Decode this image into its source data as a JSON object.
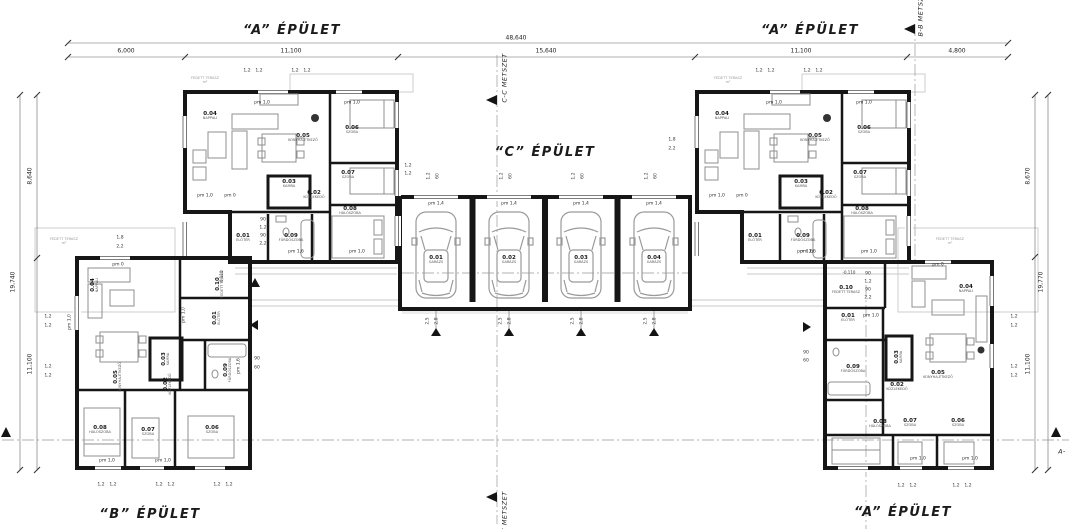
{
  "drawing": {
    "titles": {
      "building_a_top_left": "“A” ÉPÜLET",
      "building_a_top_right": "“A” ÉPÜLET",
      "building_c": "“C” ÉPÜLET",
      "building_b": "“B” ÉPÜLET",
      "building_a_bottom_right": "“A” ÉPÜLET"
    },
    "sections": {
      "bb": "B-B METSZET",
      "cc_top": "C-C METSZET",
      "cc_bottom": "C-C METSZET",
      "aa_right": "A-"
    },
    "dims": {
      "top_total": "48,640",
      "top_segments": [
        "6,000",
        "11,100",
        "15,640",
        "11,100",
        "4,800"
      ],
      "left_segments": [
        "8,640",
        "11,100"
      ],
      "left_total": "19,740",
      "right_segments": [
        "8,670",
        "11,100"
      ],
      "right_total": "19,770"
    }
  },
  "labels": {
    "rooms": [
      {
        "no": "0.04",
        "name": "NAPPALI",
        "x": 210,
        "y": 116
      },
      {
        "no": "0.05",
        "name": "KONYHA-ÉTKEZŐ",
        "x": 303,
        "y": 138
      },
      {
        "no": "0.06",
        "name": "SZOBA",
        "x": 352,
        "y": 130
      },
      {
        "no": "0.07",
        "name": "SZOBA",
        "x": 348,
        "y": 175
      },
      {
        "no": "0.03",
        "name": "KAMRA",
        "x": 289,
        "y": 184
      },
      {
        "no": "0.02",
        "name": "KÖZLEKEDŐ",
        "x": 314,
        "y": 195
      },
      {
        "no": "0.08",
        "name": "HÁLÓSZOBA",
        "x": 350,
        "y": 211
      },
      {
        "no": "0.01",
        "name": "ELŐTÉR",
        "x": 243,
        "y": 238
      },
      {
        "no": "0.09",
        "name": "FÜRDŐSZOBA",
        "x": 291,
        "y": 238
      },
      {
        "no": "0.04",
        "name": "NAPPALI",
        "x": 722,
        "y": 116
      },
      {
        "no": "0.05",
        "name": "KONYHA-ÉTKEZŐ",
        "x": 815,
        "y": 138
      },
      {
        "no": "0.06",
        "name": "SZOBA",
        "x": 864,
        "y": 130
      },
      {
        "no": "0.07",
        "name": "SZOBA",
        "x": 860,
        "y": 175
      },
      {
        "no": "0.03",
        "name": "KAMRA",
        "x": 801,
        "y": 184
      },
      {
        "no": "0.02",
        "name": "KÖZLEKEDŐ",
        "x": 826,
        "y": 195
      },
      {
        "no": "0.08",
        "name": "HÁLÓSZOBA",
        "x": 862,
        "y": 211
      },
      {
        "no": "0.01",
        "name": "ELŐTÉR",
        "x": 755,
        "y": 238
      },
      {
        "no": "0.09",
        "name": "FÜRDŐSZOBA",
        "x": 803,
        "y": 238
      },
      {
        "no": "0.04",
        "name": "NAPPALI",
        "x": 95,
        "y": 285,
        "r": -90
      },
      {
        "no": "0.05",
        "name": "KONYHA-ÉTKEZŐ",
        "x": 118,
        "y": 377,
        "r": -90
      },
      {
        "no": "0.03",
        "name": "KAMRA",
        "x": 166,
        "y": 359,
        "r": -90
      },
      {
        "no": "0.10",
        "name": "FEDETT TERASZ",
        "x": 220,
        "y": 284,
        "r": -90
      },
      {
        "no": "0.01",
        "name": "ELŐTÉR",
        "x": 217,
        "y": 318,
        "r": -90
      },
      {
        "no": "0.09",
        "name": "FÜRDŐSZOBA",
        "x": 228,
        "y": 370,
        "r": -90
      },
      {
        "no": "0.02",
        "name": "KÖZLEKEDŐ",
        "x": 168,
        "y": 384,
        "r": -90
      },
      {
        "no": "0.08",
        "name": "HÁLÓSZOBA",
        "x": 100,
        "y": 430
      },
      {
        "no": "0.07",
        "name": "SZOBA",
        "x": 148,
        "y": 432
      },
      {
        "no": "0.06",
        "name": "SZOBA",
        "x": 212,
        "y": 430
      },
      {
        "no": "0.10",
        "name": "FEDETT TERASZ",
        "x": 846,
        "y": 290
      },
      {
        "no": "0.01",
        "name": "ELŐTÉR",
        "x": 848,
        "y": 318
      },
      {
        "no": "0.04",
        "name": "NAPPALI",
        "x": 966,
        "y": 289
      },
      {
        "no": "0.05",
        "name": "KONYHA-ÉTKEZŐ",
        "x": 938,
        "y": 375
      },
      {
        "no": "0.03",
        "name": "KAMRA",
        "x": 899,
        "y": 357,
        "r": -90
      },
      {
        "no": "0.09",
        "name": "FÜRDŐSZOBA",
        "x": 853,
        "y": 369
      },
      {
        "no": "0.02",
        "name": "KÖZLEKEDŐ",
        "x": 897,
        "y": 387
      },
      {
        "no": "0.08",
        "name": "HÁLÓSZOBA",
        "x": 880,
        "y": 424
      },
      {
        "no": "0.07",
        "name": "SZOBA",
        "x": 910,
        "y": 423
      },
      {
        "no": "0.06",
        "name": "SZOBA",
        "x": 958,
        "y": 423
      }
    ],
    "garage_bays": [
      {
        "no": "0.01",
        "name": "GARÁZS",
        "x": 436,
        "y": 260
      },
      {
        "no": "0.02",
        "name": "GARÁZS",
        "x": 509,
        "y": 260
      },
      {
        "no": "0.03",
        "name": "GARÁZS",
        "x": 581,
        "y": 260
      },
      {
        "no": "0.04",
        "name": "GARÁZS",
        "x": 654,
        "y": 260
      }
    ],
    "doors": [
      {
        "t": "pm 1,0",
        "x": 262,
        "y": 104
      },
      {
        "t": "pm 1,0",
        "x": 352,
        "y": 104
      },
      {
        "t": "pm 1,0",
        "x": 205,
        "y": 197
      },
      {
        "t": "pm 0",
        "x": 230,
        "y": 197
      },
      {
        "t": "pm 1,6",
        "x": 296,
        "y": 253
      },
      {
        "t": "pm 1,0",
        "x": 357,
        "y": 253
      },
      {
        "t": "pm 1,0",
        "x": 774,
        "y": 104
      },
      {
        "t": "pm 1,0",
        "x": 864,
        "y": 104
      },
      {
        "t": "pm 1,0",
        "x": 717,
        "y": 197
      },
      {
        "t": "pm 0",
        "x": 742,
        "y": 197
      },
      {
        "t": "pm 1,6",
        "x": 808,
        "y": 253
      },
      {
        "t": "pm 1,0",
        "x": 869,
        "y": 253
      },
      {
        "t": "pm 1,4",
        "x": 436,
        "y": 205
      },
      {
        "t": "pm 1,4",
        "x": 509,
        "y": 205
      },
      {
        "t": "pm 1,4",
        "x": 581,
        "y": 205
      },
      {
        "t": "pm 1,4",
        "x": 654,
        "y": 205
      },
      {
        "t": "pm 0",
        "x": 118,
        "y": 266
      },
      {
        "t": "pm 1,0",
        "x": 71,
        "y": 322,
        "r": -90
      },
      {
        "t": "pm 1,0",
        "x": 185,
        "y": 315,
        "r": -90
      },
      {
        "t": "pm 1,6",
        "x": 240,
        "y": 366,
        "r": -90
      },
      {
        "t": "pm 1,0",
        "x": 107,
        "y": 462
      },
      {
        "t": "pm 1,0",
        "x": 163,
        "y": 462
      },
      {
        "t": "pm 0",
        "x": 938,
        "y": 266
      },
      {
        "t": "pm 1,0",
        "x": 871,
        "y": 317
      },
      {
        "t": "pm 1,6",
        "x": 805,
        "y": 253
      },
      {
        "t": "pm 1,0",
        "x": 918,
        "y": 460
      },
      {
        "t": "pm 1,0",
        "x": 970,
        "y": 460
      }
    ],
    "dims_small": [
      {
        "t": "1,2",
        "x": 247,
        "y": 72
      },
      {
        "t": "1,2",
        "x": 259,
        "y": 72
      },
      {
        "t": "1,2",
        "x": 295,
        "y": 72
      },
      {
        "t": "1,2",
        "x": 307,
        "y": 72
      },
      {
        "t": "1,2",
        "x": 759,
        "y": 72
      },
      {
        "t": "1,2",
        "x": 771,
        "y": 72
      },
      {
        "t": "1,2",
        "x": 807,
        "y": 72
      },
      {
        "t": "1,2",
        "x": 819,
        "y": 72
      },
      {
        "t": "1,2",
        "x": 430,
        "y": 176,
        "r": -90
      },
      {
        "t": "60",
        "x": 439,
        "y": 176,
        "r": -90
      },
      {
        "t": "1,2",
        "x": 503,
        "y": 176,
        "r": -90
      },
      {
        "t": "60",
        "x": 512,
        "y": 176,
        "r": -90
      },
      {
        "t": "1,2",
        "x": 575,
        "y": 176,
        "r": -90
      },
      {
        "t": "60",
        "x": 584,
        "y": 176,
        "r": -90
      },
      {
        "t": "1,2",
        "x": 648,
        "y": 176,
        "r": -90
      },
      {
        "t": "60",
        "x": 657,
        "y": 176,
        "r": -90
      },
      {
        "t": "1,2",
        "x": 408,
        "y": 167
      },
      {
        "t": "1,2",
        "x": 408,
        "y": 175
      },
      {
        "t": "1,2",
        "x": 48,
        "y": 318
      },
      {
        "t": "1,2",
        "x": 48,
        "y": 327
      },
      {
        "t": "1,2",
        "x": 48,
        "y": 368
      },
      {
        "t": "1,2",
        "x": 48,
        "y": 377
      },
      {
        "t": "1,2",
        "x": 1014,
        "y": 318
      },
      {
        "t": "1,2",
        "x": 1014,
        "y": 327
      },
      {
        "t": "1,2",
        "x": 1014,
        "y": 368
      },
      {
        "t": "1,2",
        "x": 1014,
        "y": 377
      },
      {
        "t": "1,8",
        "x": 120,
        "y": 239
      },
      {
        "t": "2,2",
        "x": 120,
        "y": 248
      },
      {
        "t": "1,8",
        "x": 672,
        "y": 141
      },
      {
        "t": "2,2",
        "x": 672,
        "y": 150
      },
      {
        "t": "90",
        "x": 263,
        "y": 221
      },
      {
        "t": "1,2",
        "x": 263,
        "y": 229
      },
      {
        "t": "90",
        "x": 263,
        "y": 237
      },
      {
        "t": "2,2",
        "x": 263,
        "y": 245
      },
      {
        "t": "90",
        "x": 868,
        "y": 275
      },
      {
        "t": "1,2",
        "x": 868,
        "y": 283
      },
      {
        "t": "90",
        "x": 868,
        "y": 291
      },
      {
        "t": "2,2",
        "x": 868,
        "y": 299
      },
      {
        "t": "90",
        "x": 257,
        "y": 360
      },
      {
        "t": "60",
        "x": 257,
        "y": 369
      },
      {
        "t": "90",
        "x": 806,
        "y": 354
      },
      {
        "t": "60",
        "x": 806,
        "y": 362
      },
      {
        "t": "2,5",
        "x": 429,
        "y": 321,
        "r": -90
      },
      {
        "t": "2,8",
        "x": 438,
        "y": 321,
        "r": -90
      },
      {
        "t": "2,5",
        "x": 502,
        "y": 321,
        "r": -90
      },
      {
        "t": "2,8",
        "x": 511,
        "y": 321,
        "r": -90
      },
      {
        "t": "2,5",
        "x": 574,
        "y": 321,
        "r": -90
      },
      {
        "t": "2,8",
        "x": 583,
        "y": 321,
        "r": -90
      },
      {
        "t": "2,5",
        "x": 647,
        "y": 321,
        "r": -90
      },
      {
        "t": "2,8",
        "x": 656,
        "y": 321,
        "r": -90
      },
      {
        "t": "1,2",
        "x": 101,
        "y": 486
      },
      {
        "t": "1,2",
        "x": 113,
        "y": 486
      },
      {
        "t": "1,2",
        "x": 159,
        "y": 486
      },
      {
        "t": "1,2",
        "x": 171,
        "y": 486
      },
      {
        "t": "1,2",
        "x": 217,
        "y": 486
      },
      {
        "t": "1,2",
        "x": 229,
        "y": 486
      },
      {
        "t": "1,2",
        "x": 901,
        "y": 487
      },
      {
        "t": "1,2",
        "x": 913,
        "y": 487
      },
      {
        "t": "1,2",
        "x": 956,
        "y": 487
      },
      {
        "t": "1,2",
        "x": 968,
        "y": 487
      }
    ],
    "levels": [
      {
        "t": "-0,110",
        "x": 222,
        "y": 277,
        "r": -90
      },
      {
        "t": "-0,110",
        "x": 849,
        "y": 273
      }
    ],
    "notes": [
      {
        "t1": "FEDETT TERASZ",
        "t2": "m²",
        "x": 64,
        "y": 241
      },
      {
        "t1": "FEDETT TERASZ",
        "t2": "m²",
        "x": 950,
        "y": 241
      },
      {
        "t1": "FEDETT TERASZ",
        "t2": "m²",
        "x": 205,
        "y": 80
      },
      {
        "t1": "FEDETT TERASZ",
        "t2": "m²",
        "x": 728,
        "y": 80
      }
    ]
  }
}
